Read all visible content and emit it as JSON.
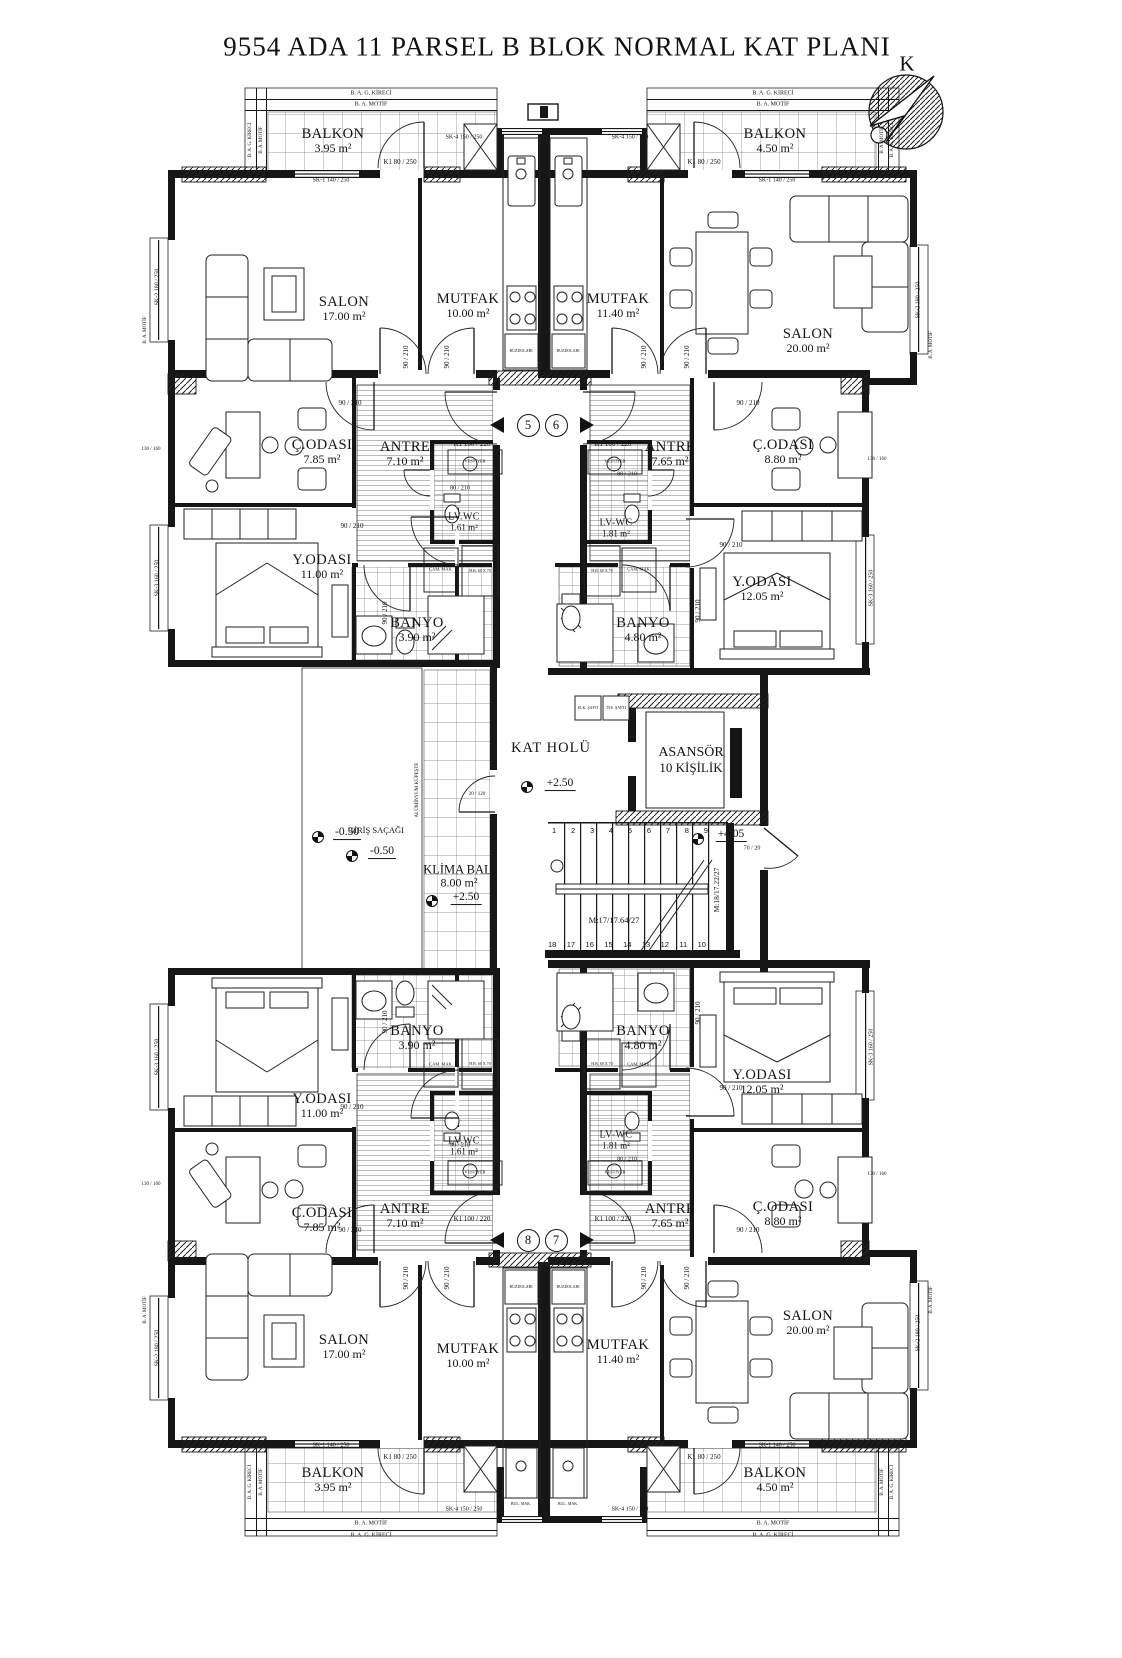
{
  "title": "9554 ADA 11 PARSEL B BLOK NORMAL KAT PLANI",
  "compass": {
    "north": "K"
  },
  "perimeter": {
    "kireci": "B. A. G. KİRECİ",
    "motif": "B. A. MOTİF"
  },
  "units": {
    "left": {
      "balkon": {
        "name": "BALKON",
        "area": "3.95 m²"
      },
      "salon": {
        "name": "SALON",
        "area": "17.00 m²"
      },
      "mutfak": {
        "name": "MUTFAK",
        "area": "10.00 m²"
      },
      "codasi": {
        "name": "Ç.ODASI",
        "area": "7.85 m²"
      },
      "antre": {
        "name": "ANTRE",
        "area": "7.10 m²"
      },
      "lvwc": {
        "name": "LV.WC",
        "area": "1.61 m²"
      },
      "yodasi": {
        "name": "Y.ODASI",
        "area": "11.00 m²"
      },
      "banyo": {
        "name": "BANYO",
        "area": "3.90 m²"
      }
    },
    "right": {
      "balkon": {
        "name": "BALKON",
        "area": "4.50 m²"
      },
      "salon": {
        "name": "SALON",
        "area": "20.00 m²"
      },
      "mutfak": {
        "name": "MUTFAK",
        "area": "11.40 m²"
      },
      "codasi": {
        "name": "Ç.ODASI",
        "area": "8.80 m²"
      },
      "antre": {
        "name": "ANTRE",
        "area": "7.65 m²"
      },
      "lvwc": {
        "name": "LV-WC",
        "area": "1.81 m²"
      },
      "yodasi": {
        "name": "Y.ODASI",
        "area": "12.05 m²"
      },
      "banyo": {
        "name": "BANYO",
        "area": "4.80 m²"
      }
    }
  },
  "core": {
    "kat_holu": "KAT HOLÜ",
    "level_hall": "+2.50",
    "asansor_line1": "ASANSÖR",
    "asansor_line2": "10 KİŞİLİK",
    "klima_name": "KLİMA BAL.",
    "klima_area": "8.00 m²",
    "klima_level": "+2.50",
    "giris_sacagi": "GİRİŞ SAÇAĞI",
    "level_giris_1": "-0.30",
    "level_giris_2": "-0.50",
    "level_landing": "+4.05",
    "stair_dim": "70 / 20",
    "stairs_top": [
      "1",
      "2",
      "3",
      "4",
      "5",
      "6",
      "7",
      "8",
      "9"
    ],
    "stairs_bottom": [
      "18",
      "17",
      "16",
      "15",
      "14",
      "13",
      "12",
      "11",
      "10"
    ],
    "m17": "M:17/17.64/27",
    "m18": "M:18/17.22/27",
    "shaft_elk": "ELK. ŞAFTI",
    "shaft_tes": "TES. ŞAFTI",
    "railing": "ALÜMİNYUM KÜPEŞTE"
  },
  "unit_numbers": {
    "n5": "5",
    "n6": "6",
    "n7": "7",
    "n8": "8"
  },
  "openings": {
    "d90": "90 / 210",
    "d80": "80 / 210",
    "k80": "K1 80 / 250",
    "k100": "K1 100 / 220",
    "sk1": "SK-1 140 / 250",
    "sk2": "SK-2 180 / 250",
    "sk3": "SK-3 160 / 250",
    "sk4": "SK-4 150 / 250",
    "dim130": "130 / 160",
    "dim20": "20 / 120"
  },
  "fixtures": {
    "vestiyer": "VESTİYER",
    "cam_mak": "ÇAM. MAK.",
    "hb": "H.B. 60 X 70",
    "buzdolabi": "BUZDOLABI",
    "bul_mak": "BUL. MAK."
  }
}
